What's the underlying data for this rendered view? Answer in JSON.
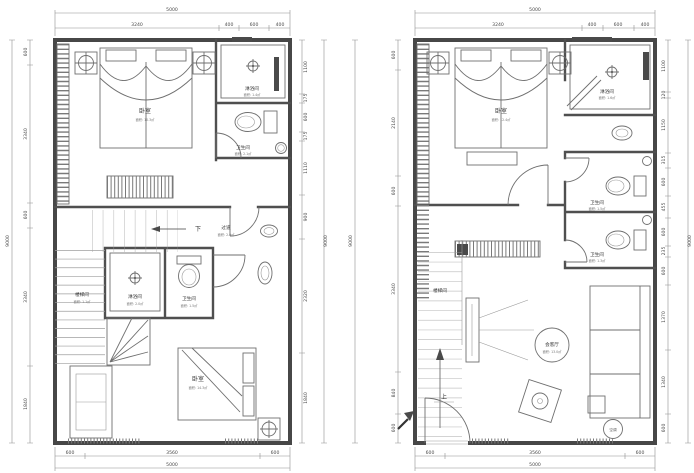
{
  "drawing": {
    "kind": "apartment two-level floor plan",
    "colors": {
      "wall": "#474747",
      "line": "#6f6f6f",
      "dim_line": "#8f8f8f",
      "text": "#333333",
      "background": "#ffffff"
    }
  },
  "plans": [
    {
      "name": "lower-floor-plan",
      "top_total": "5000",
      "top_dims": [
        "3240",
        "400",
        "600",
        "400"
      ],
      "bottom_dims": [
        "600",
        "3560",
        "600"
      ],
      "bottom_total": "5000",
      "left_total": "9000",
      "left_dims": [
        "600",
        "3340",
        "600",
        "3340",
        "1840"
      ],
      "right_total": "9000",
      "right_dims": [
        "1100",
        "175",
        "600",
        "175",
        "1110",
        "900",
        "2320",
        "1840"
      ],
      "rooms": {
        "bedroom_top": {
          "label": "卧室",
          "area": "面积: 10.3㎡"
        },
        "shower_top": {
          "label": "淋浴间",
          "area": "面积: 1.4㎡"
        },
        "wc_top": {
          "label": "卫生间",
          "area": "面积: 2.1㎡"
        },
        "corridor": {
          "label": "过道",
          "area": "面积: 2.0㎡"
        },
        "down": "下",
        "stairwell": {
          "label": "楼梯间",
          "area": "面积: 1.1㎡"
        },
        "shower_mid": {
          "label": "淋浴间",
          "area": "面积: 2.0㎡"
        },
        "wc_mid": {
          "label": "卫生间",
          "area": "面积: 1.5㎡"
        },
        "bedroom_bottom": {
          "label": "卧室",
          "area": "面积: 14.3㎡"
        }
      }
    },
    {
      "name": "upper-floor-plan",
      "top_total": "5000",
      "top_dims": [
        "3240",
        "400",
        "600",
        "400"
      ],
      "bottom_dims": [
        "600",
        "3560",
        "600"
      ],
      "bottom_total": "5000",
      "left_total": "9000",
      "left_dims": [
        "600",
        "2140",
        "600",
        "3340",
        "840",
        "600"
      ],
      "right_total": "9000",
      "right_dims": [
        "1100",
        "120",
        "1150",
        "315",
        "600",
        "455",
        "600",
        "235",
        "600",
        "1370",
        "1340",
        "600"
      ],
      "rooms": {
        "bedroom": {
          "label": "卧室",
          "area": "面积: 12.4㎡"
        },
        "shower": {
          "label": "淋浴间",
          "area": "面积: 1.6㎡"
        },
        "wc_1": {
          "label": "卫生间",
          "area": "面积: 1.5㎡"
        },
        "wc_2": {
          "label": "卫生间",
          "area": "面积: 1.3㎡"
        },
        "stairwell": {
          "label": "楼梯间"
        },
        "living": {
          "label": "会客厅",
          "area": "面积: 13.0㎡"
        },
        "up": "上",
        "ac": "空调"
      }
    }
  ]
}
